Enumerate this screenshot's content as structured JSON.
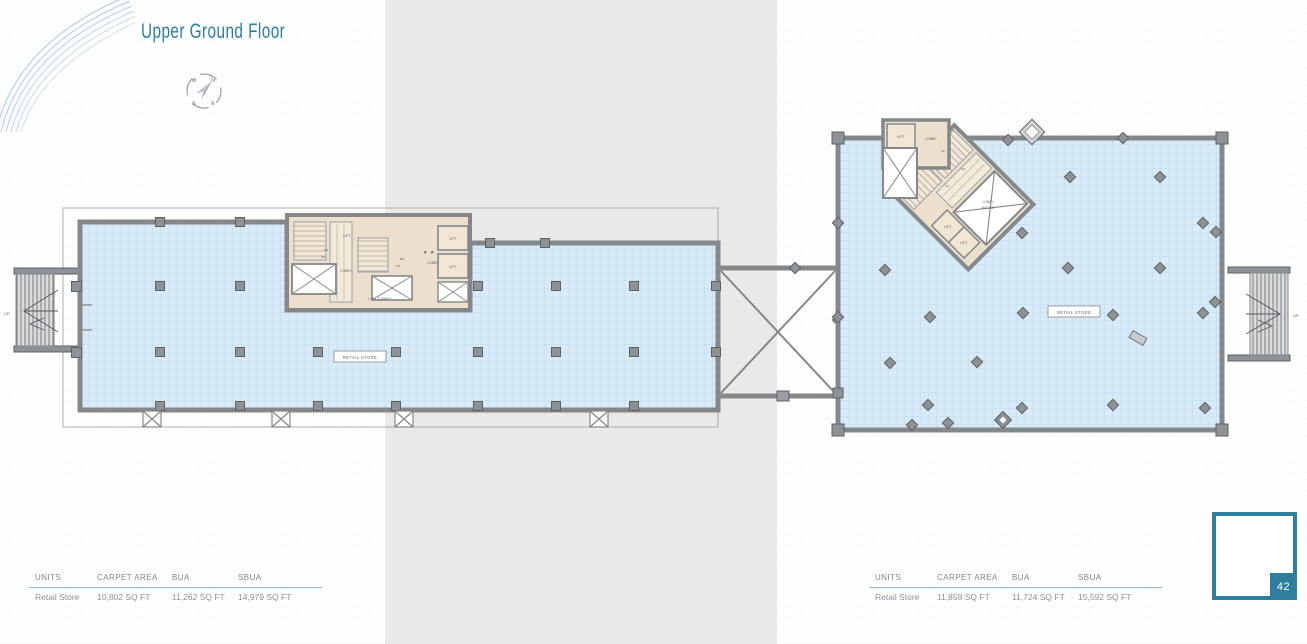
{
  "title": "Upper Ground Floor",
  "page_number": "42",
  "compass": {
    "n": "N",
    "w": "W",
    "s": "S",
    "e": "E"
  },
  "plan_labels": {
    "lift": "LIFT",
    "lobby": "LOBBY",
    "lift_lobby": "LIFT LOBBY",
    "lobby_below_1": "LOBBY",
    "lobby_below_2": "BELOW",
    "retail_store": "RETAIL STORE",
    "up": "UP",
    "dn": "DN"
  },
  "tables": {
    "left": {
      "headers": [
        "UNITS",
        "CARPET AREA",
        "BUA",
        "SBUA"
      ],
      "rows": [
        [
          "Retail Store",
          "10,802 SQ FT",
          "11,262 SQ FT",
          "14,979 SQ FT"
        ]
      ]
    },
    "right": {
      "headers": [
        "UNITS",
        "CARPET AREA",
        "BUA",
        "SBUA"
      ],
      "rows": [
        [
          "Retail Store",
          "11,858 SQ FT",
          "11,724 SQ FT",
          "15,592 SQ FT"
        ]
      ]
    }
  },
  "colors": {
    "accent": "#2e7f9d",
    "floor": "#d8eaf7",
    "wall": "#84888b",
    "core": "#ecdfcd",
    "band": "#e9e9e9"
  }
}
